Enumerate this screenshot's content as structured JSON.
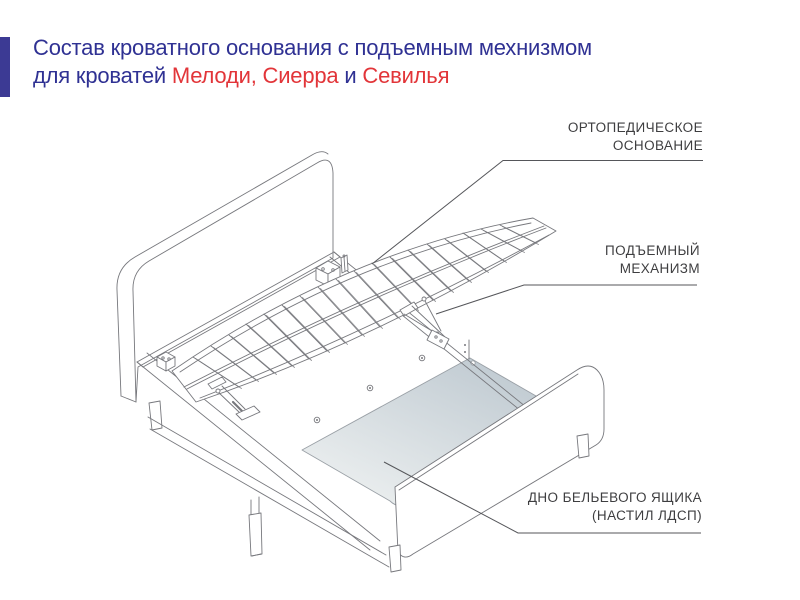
{
  "accent_bar": {
    "color": "#3c3a94"
  },
  "title": {
    "line1": "Состав кроватного основания с подъемным мехнизмом",
    "line2_prefix": "для кроватей ",
    "line2_red1": "Мелоди, Сиерра",
    "line2_mid": " и ",
    "line2_red2": "Севилья",
    "color": "#2f3193",
    "red": "#e23539"
  },
  "diagram": {
    "labels": {
      "orthopedic_base": {
        "line1": "ОРТОПЕДИЧЕСКОЕ",
        "line2": "ОСНОВАНИЕ"
      },
      "lift_mechanism": {
        "line1": "ПОДЪЕМНЫЙ",
        "line2": "МЕХАНИЗМ"
      },
      "drawer_bottom": {
        "line1": "ДНО БЕЛЬЕВОГО ЯЩИКА",
        "line2": "(НАСТИЛ ЛДСП)"
      }
    },
    "label_color": "#3e3e40",
    "line_color": "#77787d",
    "leader_color": "#55565a",
    "deck_colors": {
      "top": "#c2ccd3",
      "bottom": "#e8eced"
    }
  }
}
